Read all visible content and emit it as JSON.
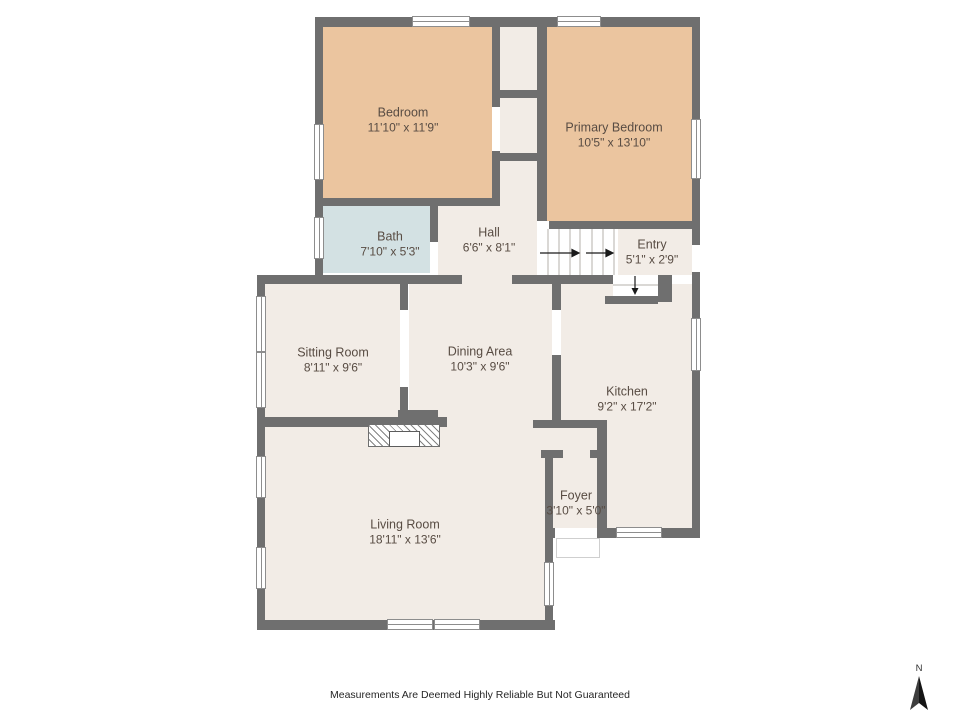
{
  "rooms": {
    "bedroom": {
      "name": "Bedroom",
      "dims": "11'10\" x 11'9\""
    },
    "primary_bedroom": {
      "name": "Primary Bedroom",
      "dims": "10'5\" x 13'10\""
    },
    "bath": {
      "name": "Bath",
      "dims": "7'10\" x 5'3\""
    },
    "hall": {
      "name": "Hall",
      "dims": "6'6\" x 8'1\""
    },
    "entry": {
      "name": "Entry",
      "dims": "5'1\" x 2'9\""
    },
    "sitting_room": {
      "name": "Sitting Room",
      "dims": "8'11\" x 9'6\""
    },
    "dining_area": {
      "name": "Dining Area",
      "dims": "10'3\" x 9'6\""
    },
    "kitchen": {
      "name": "Kitchen",
      "dims": "9'2\" x 17'2\""
    },
    "foyer": {
      "name": "Foyer",
      "dims": "3'10\" x 5'0\""
    },
    "living_room": {
      "name": "Living Room",
      "dims": "18'11\" x 13'6\""
    }
  },
  "footer": {
    "disclaimer": "Measurements Are Deemed Highly Reliable But Not Guaranteed"
  },
  "compass": {
    "north_label": "N"
  },
  "colors": {
    "wall": "#6f6f6f",
    "floor": "#f2ece6",
    "bedroom_fill": "#ebc59f",
    "bath_fill": "#d3e1e3",
    "label_text": "#584c43"
  }
}
